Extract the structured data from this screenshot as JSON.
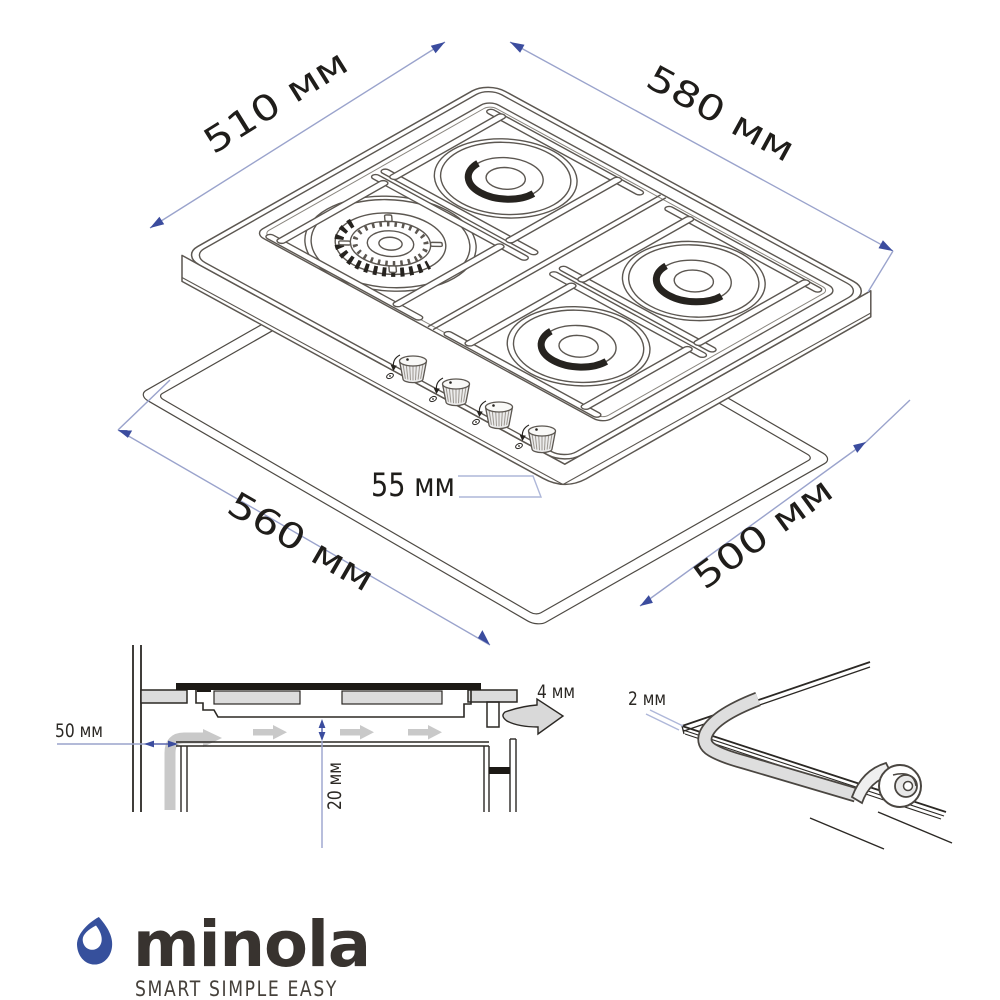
{
  "page": {
    "background": "#ffffff"
  },
  "colors": {
    "dimension_line": "#9aa3cc",
    "dimension_arrow": "#3b4c9e",
    "drawing_line": "#5c5751",
    "section_line": "#2b2824",
    "fill_gray": "#dcdcdc",
    "flow_gray": "#c9c9c9",
    "logo_blue": "#36509c",
    "logo_text": "#38332f"
  },
  "top_drawing": {
    "dim_depth_top": "510 мм",
    "dim_width_top": "580 мм",
    "dim_cutout_width": "560 мм",
    "dim_cutout_depth": "500 мм",
    "dim_body_height": "55 мм"
  },
  "installation_drawing": {
    "dim_wall_distance": "50 мм",
    "dim_bottom_clearance": "20 мм",
    "dim_edge_gap": "4 мм"
  },
  "edge_detail_drawing": {
    "dim_seal_thickness": "2 мм"
  },
  "logo": {
    "brand": "minola",
    "tagline": "SMART SIMPLE EASY"
  }
}
